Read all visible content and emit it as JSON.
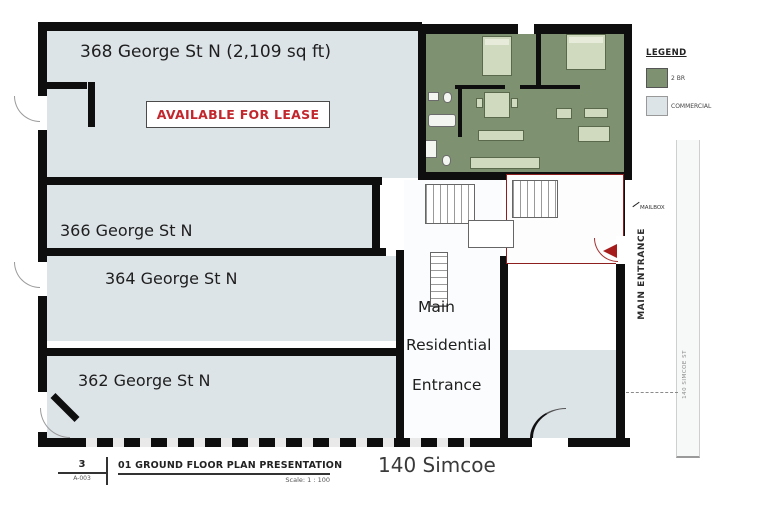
{
  "plan": {
    "units": {
      "u368": {
        "label": "368 George St N (2,109 sq ft)"
      },
      "u366": {
        "label": "366 George St N"
      },
      "u364": {
        "label": "364 George St N"
      },
      "u362": {
        "label": "362 George St N"
      }
    },
    "lease_badge": "AVAILABLE FOR LEASE",
    "residential_entrance": {
      "line1": "Main",
      "line2": "Residential",
      "line3": "Entrance"
    },
    "main_entrance_label": "MAIN ENTRANCE",
    "mailbox_label": "MAILBOX",
    "street_label": "140 SIMCOE ST"
  },
  "legend": {
    "title": "LEGEND",
    "items": [
      {
        "label": "2 BR",
        "color": "#7e9170"
      },
      {
        "label": "COMMERCIAL",
        "color": "#dde4e8"
      }
    ]
  },
  "title_block": {
    "detail_number": "3",
    "sheet_number": "A-003",
    "title": "01 GROUND FLOOR PLAN PRESENTATION",
    "scale": "Scale: 1 : 100"
  },
  "caption": "140 Simcoe",
  "colors": {
    "commercial_fill": "#dde4e8",
    "residential_fill": "#7e9170",
    "wall": "#0e0e0e",
    "lease_red": "#c1272d",
    "boundary_red": "#8e1f1f"
  }
}
